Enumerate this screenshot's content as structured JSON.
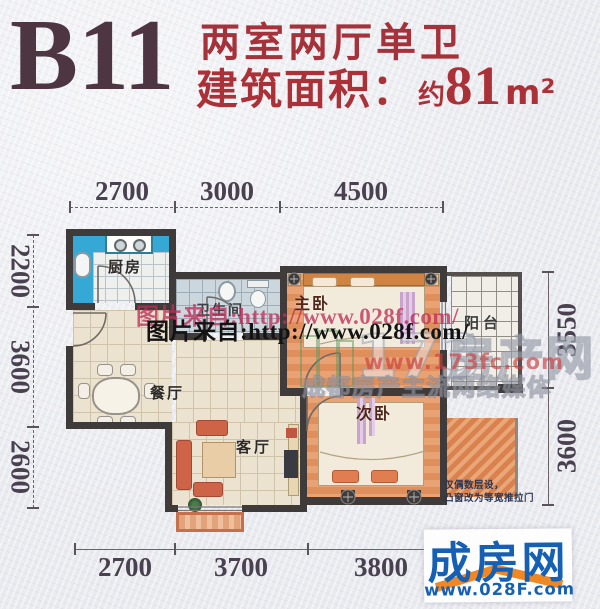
{
  "header": {
    "plan_code": "B11",
    "layout_title": "两室两厅单卫",
    "area_label": "建筑面积：",
    "area_prefix": "约",
    "area_value": "81",
    "area_unit": "m²"
  },
  "dimensions": {
    "top": [
      "2700",
      "3000",
      "4500"
    ],
    "bottom": [
      "2700",
      "3700",
      "3800"
    ],
    "left": [
      "2200",
      "3600",
      "2600"
    ],
    "right": [
      "3550",
      "3600"
    ]
  },
  "rooms": {
    "kitchen": {
      "label": "厨房"
    },
    "bathroom": {
      "label": "卫生间"
    },
    "master_bedroom": {
      "label": "主卧"
    },
    "balcony": {
      "label": "阳台"
    },
    "dining": {
      "label": "餐厅"
    },
    "living": {
      "label": "客厅"
    },
    "second_bedroom": {
      "label": "次卧"
    }
  },
  "note": {
    "line1": "仅偶数层设，",
    "line2": "凸窗改为等宽推拉门"
  },
  "watermarks": {
    "source_text": "图片来自:http://www.028f.com/",
    "site_digits": "173",
    "site_name": "房产网",
    "site_url": "www.173fc.com",
    "slogan": "成都房产主流网络媒体"
  },
  "logo": {
    "name": "成房网",
    "url": "www.028F.com"
  },
  "colors": {
    "accent_red": "#a5323a",
    "wall": "#3f3b3a",
    "kitchen_blue": "#35a8d6",
    "logo_blue": "#1660b4",
    "logo_orange": "#ef8722"
  }
}
